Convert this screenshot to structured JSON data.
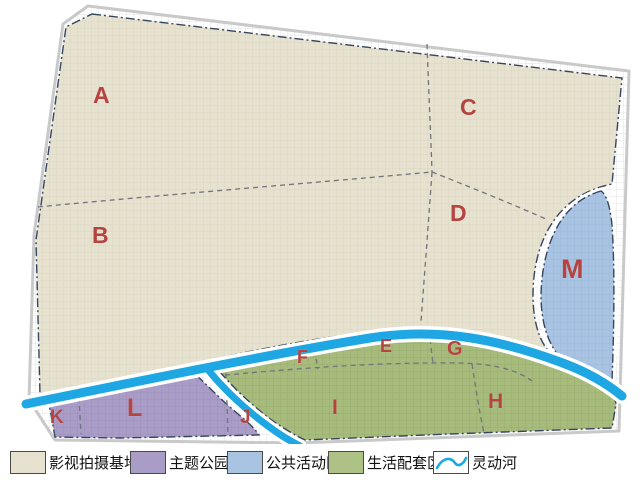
{
  "map": {
    "title": "片区规划分区图",
    "river_name": "灵动河",
    "zones": [
      {
        "id": "A",
        "label": "A",
        "category": "影视拍摄基地"
      },
      {
        "id": "B",
        "label": "B",
        "category": "影视拍摄基地"
      },
      {
        "id": "C",
        "label": "C",
        "category": "影视拍摄基地"
      },
      {
        "id": "D",
        "label": "D",
        "category": "影视拍摄基地"
      },
      {
        "id": "E",
        "label": "E",
        "category": "生活配套区"
      },
      {
        "id": "F",
        "label": "F",
        "category": "生活配套区"
      },
      {
        "id": "G",
        "label": "G",
        "category": "生活配套区"
      },
      {
        "id": "H",
        "label": "H",
        "category": "生活配套区"
      },
      {
        "id": "I",
        "label": "I",
        "category": "生活配套区"
      },
      {
        "id": "J",
        "label": "J",
        "category": "主题公园"
      },
      {
        "id": "K",
        "label": "K",
        "category": "主题公园"
      },
      {
        "id": "L",
        "label": "L",
        "category": "主题公园"
      },
      {
        "id": "M",
        "label": "M",
        "category": "公共活动区"
      }
    ]
  },
  "legend": {
    "items": [
      {
        "label": "影视拍摄基地",
        "type": "film-base",
        "color": "#e7e2cf"
      },
      {
        "label": "主题公园",
        "type": "theme-park",
        "color": "#a99cc6"
      },
      {
        "label": "公共活动区",
        "type": "public-activity",
        "color": "#a9c3e3"
      },
      {
        "label": "生活配套区",
        "type": "living-support",
        "color": "#afc286"
      },
      {
        "label": "灵动河",
        "type": "river",
        "color": "#1fa7e3"
      }
    ]
  },
  "colors": {
    "film_base_fill": "#e7e2cf",
    "theme_park_fill": "#a99cc6",
    "public_activity_fill": "#a9c3e3",
    "living_support_fill": "#afc286",
    "river_blue": "#1fa7e3",
    "boundary_dashdot": "#36455f",
    "inner_dashed": "#70757c",
    "zone_label_red": "#b5433f",
    "road_outline_gray": "#c9c9c9"
  }
}
